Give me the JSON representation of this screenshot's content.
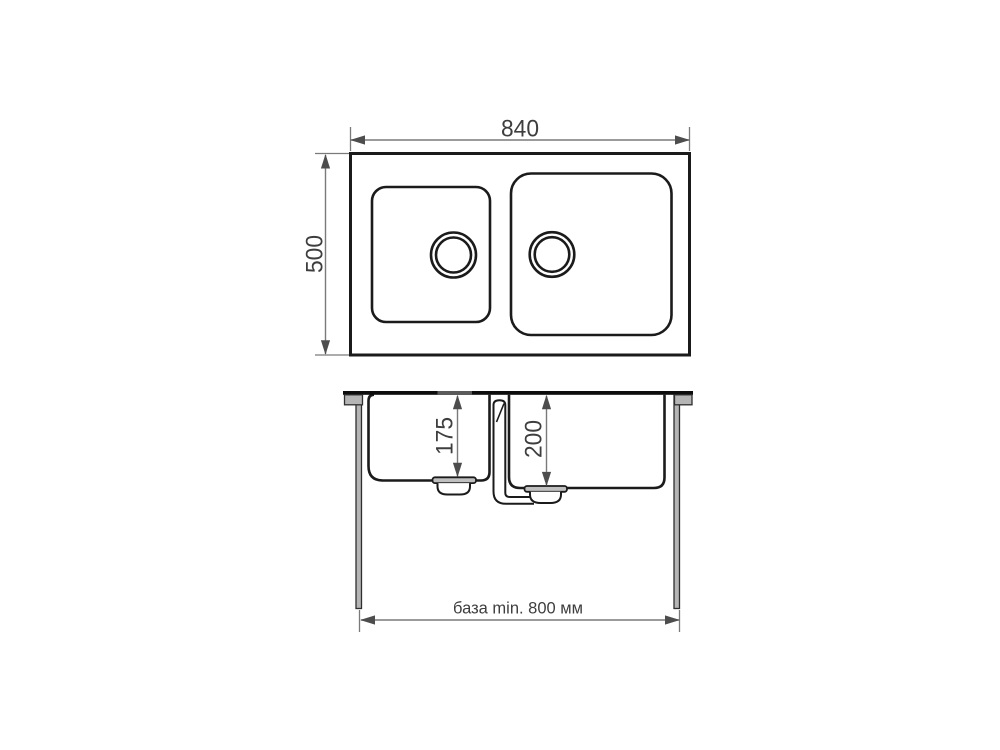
{
  "labels": {
    "top_width": "840",
    "top_depth": "500",
    "left_bowl_depth": "175",
    "right_bowl_depth": "200",
    "base_min": "база min. 800 мм"
  },
  "colors": {
    "outline": "#1b1b1b",
    "dimension_line": "#7a7a7a",
    "arrow": "#4d4d4d",
    "text": "#3e3e3e",
    "leg_fill": "#b5b5b5",
    "flange_fill": "#c0c0c0",
    "countertop": "#0d0d0d",
    "counter_hole": "#5a5a5a",
    "background": "#ffffff"
  }
}
